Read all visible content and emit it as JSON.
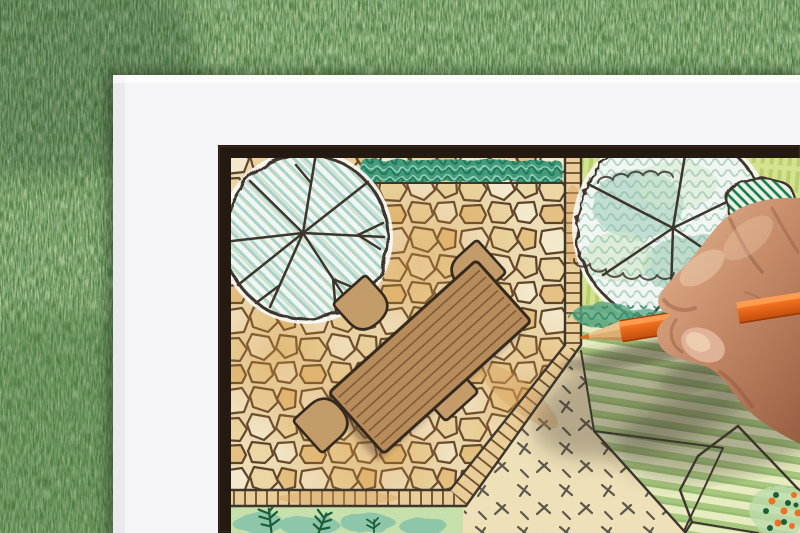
{
  "scene": {
    "subject": "Hand holding an orange colored pencil drawing a backyard garden landscape design plan on white paper over green grass",
    "background": "artificial grass lawn",
    "paper": "white sheet with black-framed landscape drawing",
    "plan_elements": [
      "large round tree canopy symbol with teal hatching",
      "clipped hedge strip",
      "flagstone patio",
      "rectangular wooden dining table",
      "four rounded patio chairs",
      "brick edging strips and ladder path",
      "striped green lawn",
      "beige groundcover bed with tick marks",
      "planting bed with conifer sprigs",
      "scalloped tree canopy over yellow-green bed",
      "dark hatched shrub",
      "flowering shrub with orange blooms"
    ],
    "furniture": {
      "tables": 1,
      "chairs": 4
    }
  },
  "colors": {
    "grass_base": "#4d7c3e",
    "grass_dark": "#2c4f26",
    "grass_light": "#7fae63",
    "grass_pale": "#a9bf9a",
    "paper": "#f5f5f7",
    "frame": "#241a11",
    "ink": "#3a332a",
    "stone_bg": "#efe0b9",
    "stone_light": "#f6ecd0",
    "stone_mid": "#eed9a6",
    "stone_warm": "#e7c384",
    "stone_line": "#5a4026",
    "stone_tint": "#d9973f",
    "brick_fill": "#ecd09a",
    "brick_warm": "#d9a360",
    "brick_line": "#6b4a28",
    "hedge_base": "#3f9c7d",
    "hedge_dark": "#1b7a5a",
    "hedge_light": "#93d2b9",
    "tree_fill": "#f4faf7",
    "tree_hatch": "#a9d4cb",
    "tree_hatch2": "#c6ddc3",
    "bed_base": "#d7e591",
    "bed_stroke": "#accb5f",
    "foliage_teal": "#55a686",
    "foliage_dark": "#2e8a63",
    "foliage_light": "#bedfae",
    "shrub_fill": "#edf5ea",
    "shrub_hatch": "#14794a",
    "lawn_light": "#e9efc3",
    "lawn_green": "#a7ca7e",
    "lawn_dark": "#8cb267",
    "ground_beige": "#f1e3ba",
    "dash_color": "#5d564b",
    "wash_green": "#c8e3ae",
    "wash_teal": "#7fc2ab",
    "conifer": "#175d37",
    "table_fill": "#b98c59",
    "table_line": "#7d5a36",
    "chair_fill": "#c59d6a",
    "outline_dark": "#32271b",
    "pencil_orange": "#f0701e",
    "pencil_hi": "#ff9f54",
    "pencil_dark": "#c24d0d",
    "pencil_wood": "#dcae72",
    "pencil_lead": "#d96c22",
    "skin_base": "#c58a68",
    "skin_light": "#e2b18d",
    "skin_pale": "#f2d4b6",
    "skin_shadow": "#9a6043",
    "skin_deep": "#7c4732",
    "nail": "#dfb197",
    "shadow_soft": "rgba(62,54,42,0.33)"
  }
}
